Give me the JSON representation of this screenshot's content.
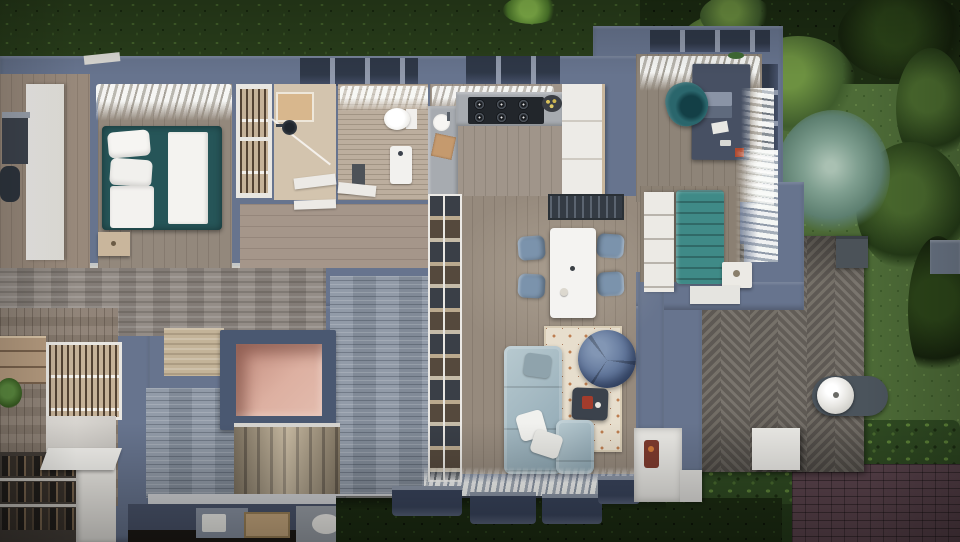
{
  "scene": {
    "title": "Top-down 3D floor plan render of a modern house",
    "level_note": "ground floor with stair void revealing lower-level entry",
    "rooms": [
      {
        "name": "bedroom"
      },
      {
        "name": "walk-in closet"
      },
      {
        "name": "shower room"
      },
      {
        "name": "bathroom"
      },
      {
        "name": "kitchen"
      },
      {
        "name": "dining area"
      },
      {
        "name": "living room"
      },
      {
        "name": "home office"
      },
      {
        "name": "reading nook"
      },
      {
        "name": "hallway"
      },
      {
        "name": "staircase to lower level"
      },
      {
        "name": "stair void opening"
      },
      {
        "name": "lower-level entry with shoe storage"
      },
      {
        "name": "wooden deck"
      },
      {
        "name": "garden"
      },
      {
        "name": "brick driveway"
      },
      {
        "name": "left side room"
      }
    ],
    "furniture": [
      "double bed",
      "nightstand",
      "wardrobe",
      "clothes rail",
      "toilet",
      "shower",
      "bathroom sink",
      "gas cooktop",
      "kitchen counters",
      "fridge cabinets",
      "fruit bowl",
      "dining table",
      "dining chairs",
      "skylight panel",
      "corner sofa",
      "throw pillows",
      "coffee table",
      "bean bag",
      "area rug",
      "open shelving divider",
      "desk",
      "laptop",
      "office chair",
      "tufted bench",
      "bookshelf",
      "side table",
      "stove niche",
      "barbecue grill",
      "planter box",
      "shoe rack",
      "white curtains"
    ]
  },
  "palette": {
    "wall": "#67748e",
    "wallLight": "#929cb2",
    "wallDark": "#45506a",
    "grass": "#293e1b",
    "lawn": "#4d6b37",
    "bedTeal": "#265558",
    "benchTeal": "#3f8a87",
    "chairTeal": "#2a666c",
    "sofaBlue": "#a6bac2",
    "beanBlue": "#5e7397",
    "chairBlue": "#7b93ac",
    "rugCream": "#e7decd",
    "rugAccent": "#bd7e51",
    "counter": "#a7abb0",
    "cooktop": "#22262b",
    "cabinetWhite": "#edebe7",
    "woodTan": "#c9b69c",
    "floorWood": "#96897b",
    "stoneMasonry": "#8e8781",
    "stoneBlue": "#8c96a3",
    "salmon": "#d4a295",
    "stairTread": "#b3a389",
    "deckWood": "#6e6963",
    "brickDrive": "#5a434c",
    "brickRed": "#6f4641",
    "desk": "#475063",
    "curtain": "#f3f4f2"
  }
}
